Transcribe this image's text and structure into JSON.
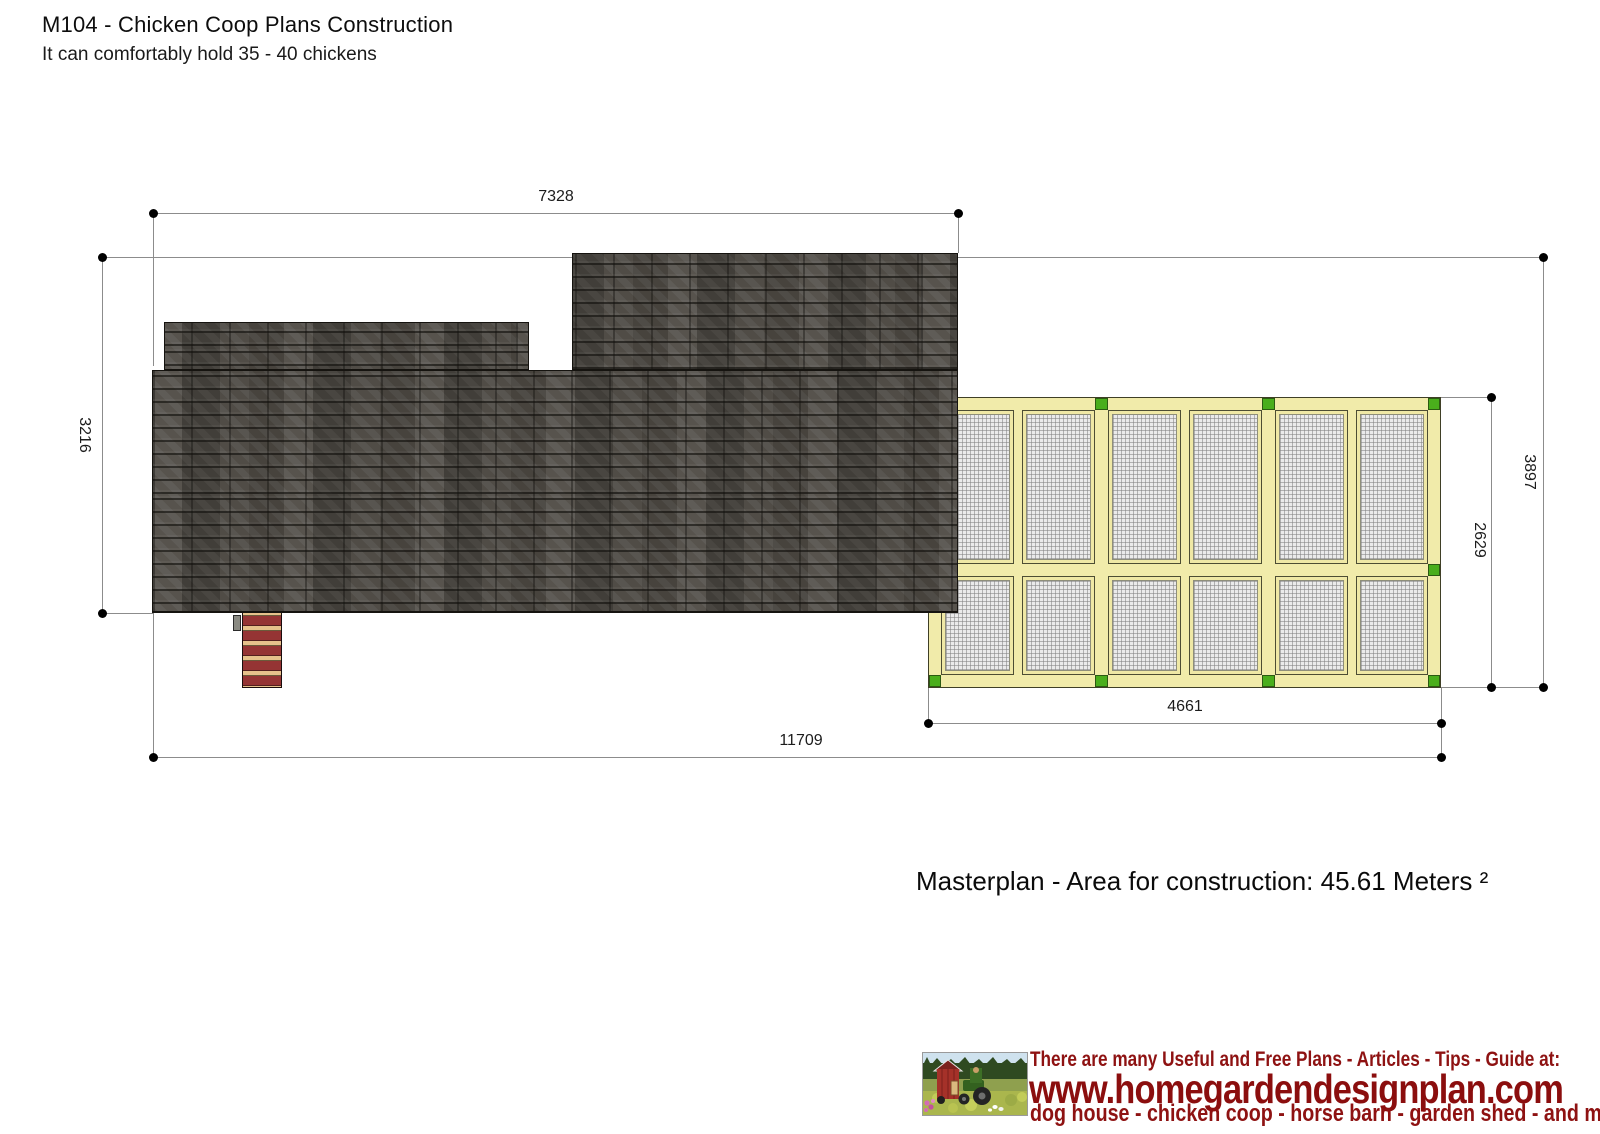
{
  "page": {
    "title": "M104 - Chicken Coop Plans Construction",
    "subtitle": "It can comfortably hold 35 - 40 chickens"
  },
  "plan": {
    "caption": "Masterplan - Area for construction: 45.61 Meters ²",
    "dimensions": {
      "roof_width": "7328",
      "roof_depth": "3216",
      "overall_depth": "3897",
      "run_depth": "2629",
      "run_width": "4661",
      "overall_width": "11709"
    },
    "colors": {
      "roof_shingle": "#504c46",
      "wood_frame": "#f1ebaa",
      "connector_green": "#4aae1c",
      "mesh": "#eaeaea",
      "ramp_red": "#953434",
      "ramp_tan": "#e6c18b",
      "dimension_line": "#8c8c8c"
    }
  },
  "footer": {
    "tagline": "There are many Useful and Free Plans - Articles - Tips - Guide at:",
    "website": "www.homegardendesignplan.com",
    "categories": "dog house - chicken coop - horse barn - garden shed - and more",
    "logo": "red-coop-and-tractor-scene",
    "text_color": "#8e1212"
  }
}
